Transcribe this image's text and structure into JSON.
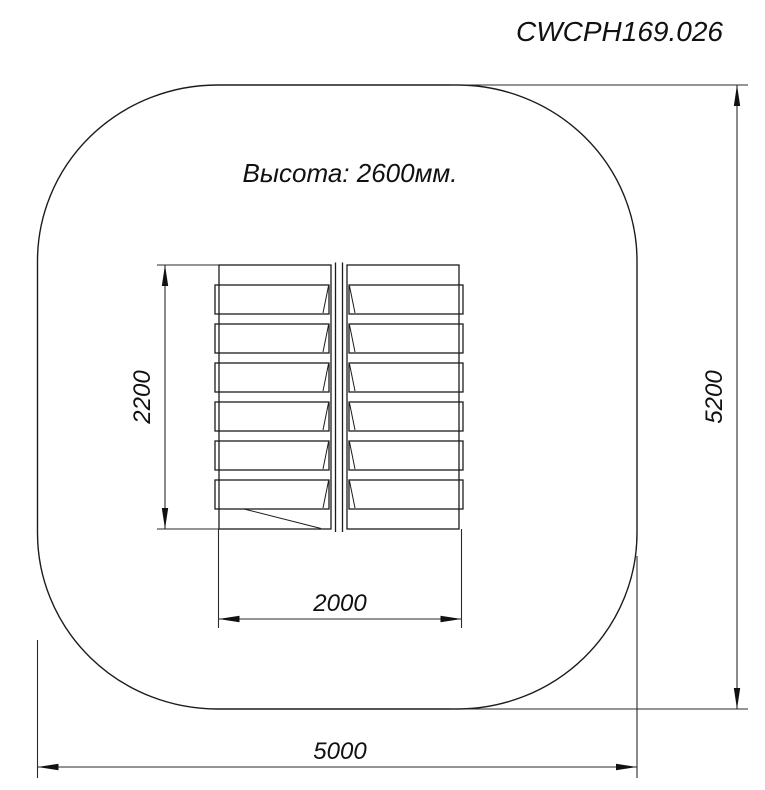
{
  "drawing": {
    "code": "CWCPH169.026",
    "height_label": "Высота: 2600мм.",
    "dimensions": {
      "platform_width_mm": "2000",
      "platform_depth_mm": "2200",
      "safety_zone_width_mm": "5000",
      "safety_zone_depth_mm": "5200"
    },
    "colors": {
      "line": "#1c1c1c",
      "background": "#ffffff",
      "text": "#111111"
    }
  }
}
